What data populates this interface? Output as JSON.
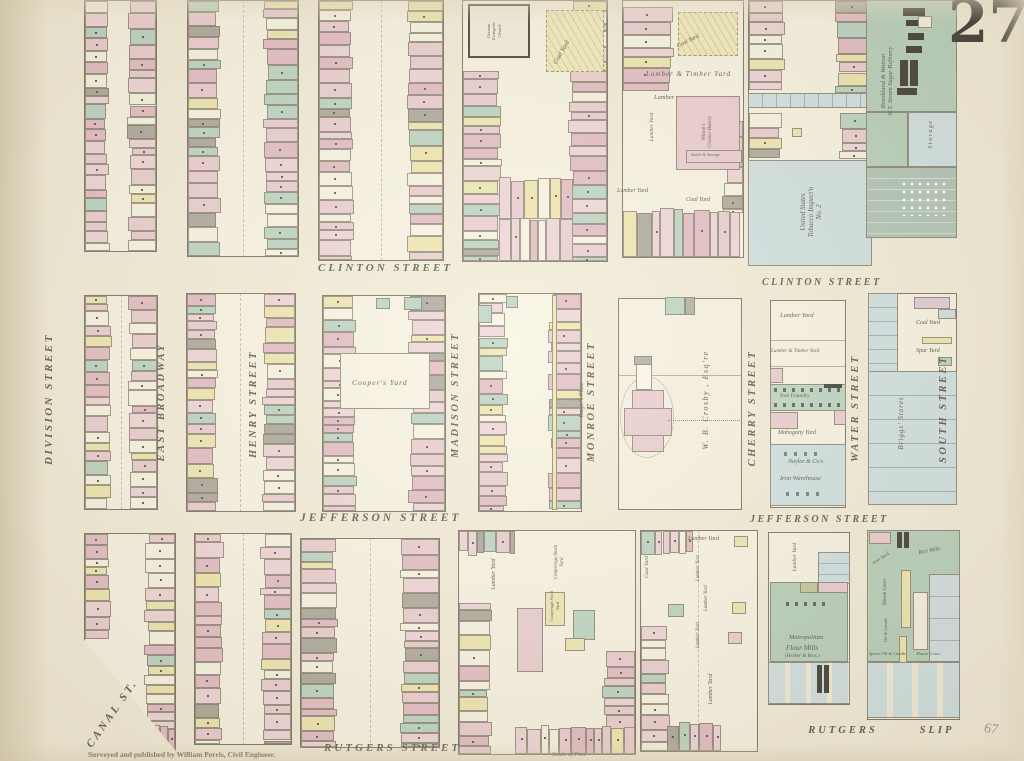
{
  "plate_number": "27",
  "streets": {
    "clinton": "CLINTON STREET",
    "division": "DIVISION STREET",
    "east_broadway": "EAST BROADWAY",
    "henry": "HENRY STREET",
    "madison": "MADISON STREET",
    "monroe": "MONROE STREET",
    "rutgers_place": "Rutger's Place",
    "cherry": "CHERRY STREET",
    "water": "WATER STREET",
    "south": "SOUTH STREET",
    "jefferson": "JEFFERSON STREET",
    "rutgers": "RUTGERS STREET",
    "rutgers_slip_word1": "RUTGERS",
    "rutgers_slip_word2": "SLIP",
    "canal": "CANAL ST."
  },
  "labels": {
    "german_church_1": "German",
    "german_church_2": "Evangelic",
    "german_church_3": "Church",
    "coal_yard": "Coal Yard",
    "lumber_yard": "Lumber Yard",
    "lumber": "Lumber",
    "lumber_timber_yard": "Lumber & Timber Yard",
    "wilsons_1": "Wilson's",
    "wilsons_2": "Cracker Bakery",
    "stable_storage": "Stable & Storage",
    "tobacco_1": "United States",
    "tobacco_2": "Tobacco Inspect'n",
    "tobacco_3": "No. 2",
    "refinery_1": "Brookland & Watson",
    "refinery_2": "N.Y. Steam Sugar Refinery",
    "storage": "Storage",
    "coopers_yard": "Cooper's Yard",
    "crosby": "W. B. Crosby , Esq're",
    "iron_foundry": "Iron Foundry",
    "mahogany_yard": "Mahogany Yard",
    "naylor_1": "Naylor & Co's",
    "naylor_2": "Iron Warehouse",
    "spar_yard": "Spar Yard",
    "briggs_stores": "Briggs' Stores",
    "cooperage_1": "Cooperage Stock",
    "cooperage_2": "Yard",
    "metropolitan_1": "Metropolitan",
    "metropolitan_2": "Flour  Mills",
    "metropolitan_3": "(Hecker & Bros.)",
    "rice_mills": "Rice Mills",
    "iron_yard": "Iron Yard",
    "mason_court": "Mason Court",
    "oil_candle": "Oil & Candle",
    "sperm_oil_candle": "Sperm Oil & Candle"
  },
  "credits": {
    "surveyor": "Surveyed and published by William Perris, Civil Engineer.",
    "scale_label": "Scale of Feet",
    "handwritten": "67"
  },
  "map_colors": {
    "pink_brick": "#e7c3cb",
    "yellow_frame": "#ece3a6",
    "green_special": "#aecbba",
    "blue_stores": "#c6dbe0",
    "paper": "#f0e9d5"
  }
}
